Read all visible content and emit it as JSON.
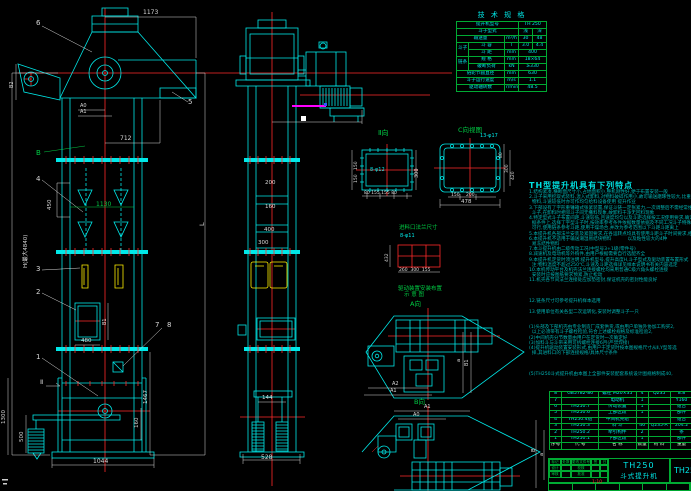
{
  "colors": {
    "line": "#00e8e8",
    "dim": "#d9d9d9",
    "green": "#00cc44",
    "red": "#ff2a2a",
    "yellow": "#ffee00",
    "magenta": "#ff00ff",
    "teal": "#00b4b4"
  },
  "spec_table": {
    "title": "技 术 规 格",
    "col_widths": [
      12,
      36,
      14,
      14,
      14
    ],
    "rows": [
      [
        {
          "t": "提升机型号",
          "cs": 3
        },
        {
          "t": "TH 250",
          "cs": 2
        }
      ],
      [
        {
          "t": "斗子型式",
          "cs": 3
        },
        {
          "t": "浅"
        },
        {
          "t": "深"
        }
      ],
      [
        {
          "t": "输送量",
          "cs": 2
        },
        {
          "t": "m³/h"
        },
        {
          "t": "30"
        },
        {
          "t": "48"
        }
      ],
      [
        {
          "t": "斗子",
          "rs": 2
        },
        {
          "t": "斗 容"
        },
        {
          "t": "l"
        },
        {
          "t": "3.0"
        },
        {
          "t": "4.4"
        }
      ],
      [
        {
          "t": "斗 距"
        },
        {
          "t": "mm"
        },
        {
          "t": "400",
          "cs": 2
        }
      ],
      [
        {
          "t": "链条",
          "rs": 2
        },
        {
          "t": "规 格"
        },
        {
          "t": "mm"
        },
        {
          "t": "18×64",
          "cs": 2
        }
      ],
      [
        {
          "t": "破断负荷"
        },
        {
          "t": "kN"
        },
        {
          "t": "≥330",
          "cs": 2
        }
      ],
      [
        {
          "t": "链轮节圆直径",
          "cs": 2
        },
        {
          "t": "mm"
        },
        {
          "t": "630",
          "cs": 2
        }
      ],
      [
        {
          "t": "斗子运行速度",
          "cs": 2
        },
        {
          "t": "m/s"
        },
        {
          "t": "1.1",
          "cs": 2
        }
      ],
      [
        {
          "t": "驱动轴转数",
          "cs": 2
        },
        {
          "t": "r/min"
        },
        {
          "t": "48.5",
          "cs": 2
        }
      ]
    ]
  },
  "notes": {
    "title": "TH型提升机具有下列特点",
    "lines": [
      "1.结构紧凑,横断面尺寸小,占地面积小,整机刚性好,便于布置安装一般",
      "2.斗子采用挖取式装料,混入式卸料,对物料破碎作用小,故可输送磨琢性较大,比重大一定块度的",
      "  物料,斗速较低时亦可作均匀给料设备使用 提升作业",
      "3.下部设有了字形重锤箱式张紧装置,保证斗链一定张紧力,一次调整后不需经常维护,了字形",
      "  斗子,在卸料时相邻斗子间无撒料现象,故卸料干净无回料现象",
      "4.特定型式斗子布置间距,斗速较低,且速度均匀以及斗距选择按工况使用要求,确定斗速布置依",
      "  据条件上,选择丁字型斗子时,按效率参考条件依据数量依据及不同工况斗子特殊斗速之上",
      "  可行,使用链条参考斗距,使用干燥场合,并改为参考范围以下斗距斗距离上",
      "5.本提升机各部法兰安装及紧固要求,在各运转点均具有使用斗距斗子时间要求,相差最大一只",
      "6.本提升机不适用于输送潮湿易结块物料           以及粘性较大的4种",
      "  易冻结性物料",
      "7.本斗提升机由二级传动工况(中型号3+1级(零件号)",
      "8.减速机及电动机等外购件,由用户根据需要自行选配齐全",
      "9.本提升机定货时须注明:提升机型号,提升高度H,斗子型式及驱动装置布置形式",
      "  注:物料温度不超过250℃,斗速及斗距选择详见样本说明书有关内容选定",
      "10.本机传动平台及机壳法兰连接螺栓均采用普通C级六角头螺栓连接",
      "  安装时应按图纸要求预紧,防止松动",
      "11.机壳各节间法兰连接处应加垫密封,保证机壳的密封性能良好",
      "",
      "",
      "",
      "12.链条尺寸可参考提升机样本选用",
      "",
      "13.使用单位有关各型二次运转化,安装时调整斗子一只",
      "",
      "",
      "(1)头部及下部机壳由专业制造厂成套供货,或由用户单独外协加工购买2,",
      "  以上必须带有斗子螺栓检验,符合上述螺栓规格及标准检验2,",
      "(2)中间机壳分节数量由用户在定货时一次确定好",
      "(3)加料斗与斗带采用可拆螺栓连接6月(严禁焊接)",
      "(4)提升机驱动装置安装形式,由用户于定货时按本图规格尺寸从Ⅱ,Y型等选",
      "  择,其进料口的下部连接规格/具体尺寸条件",
      "",
      "",
      "",
      "(5)TH250斗式提升机由本图上全部件安装配套系统设计图规格制成40,"
    ]
  },
  "bom": {
    "col_widths": [
      9,
      38,
      38,
      12,
      22,
      24,
      17
    ],
    "header": [
      "序号",
      "代  号",
      "名  称",
      "数量",
      "材 料",
      "重量",
      ""
    ],
    "rows": [
      [
        "8",
        "GB5782-86",
        "螺栓 M20×35",
        "4",
        "Q235",
        "8.8",
        ""
      ],
      [
        "7",
        "",
        "电动机",
        "1",
        "",
        "Y160",
        ""
      ],
      [
        "6",
        "TH250.7",
        "传动装置",
        "1",
        "",
        "组合",
        ""
      ],
      [
        "5",
        "TH250.6",
        "上部区段",
        "1",
        "",
        "部件",
        ""
      ],
      [
        "4",
        "TH250.4组",
        "中间机壳组",
        "",
        "",
        "组合",
        ""
      ],
      [
        "3",
        "TH250.3",
        "料 斗",
        "46",
        "Q235-A",
        "204.2",
        ""
      ],
      [
        "2",
        "TH250.2",
        "牵引构件",
        "2",
        "",
        "条",
        ""
      ],
      [
        "1",
        "TH250.1",
        "下部区段",
        "1",
        "",
        "部件",
        ""
      ]
    ]
  },
  "title_block": {
    "model": "TH250",
    "product": "斗式提升机",
    "drawing_no": "TH25",
    "rev_labels": [
      "标记",
      "处数",
      "更改文件号",
      "签名",
      "日期",
      "设计",
      "",
      "校核",
      "",
      "",
      "审核",
      "",
      "批准",
      "",
      ""
    ]
  },
  "annotations": [
    {
      "n": "dim-1173",
      "t": "1173",
      "x": 143,
      "y": 10,
      "c": "dim",
      "s": 6
    },
    {
      "n": "balloon-6",
      "t": "6",
      "x": 36,
      "y": 20,
      "c": "dim",
      "s": 7
    },
    {
      "n": "balloon-5",
      "t": "5",
      "x": 188,
      "y": 99,
      "c": "dim",
      "s": 7
    },
    {
      "n": "dim-b2",
      "t": "B2",
      "x": 10,
      "y": 88,
      "c": "dim",
      "s": 5,
      "r": 1
    },
    {
      "n": "dim-a0",
      "t": "A0",
      "x": 80,
      "y": 104,
      "c": "dim",
      "s": 5
    },
    {
      "n": "dim-a1",
      "t": "A1",
      "x": 80,
      "y": 110,
      "c": "dim",
      "s": 5
    },
    {
      "n": "label-b",
      "t": "B",
      "x": 36,
      "y": 150,
      "c": "green",
      "s": 7
    },
    {
      "n": "dim-712",
      "t": "712",
      "x": 120,
      "y": 136,
      "c": "dim",
      "s": 6
    },
    {
      "n": "balloon-4",
      "t": "4",
      "x": 36,
      "y": 176,
      "c": "dim",
      "s": 7
    },
    {
      "n": "dim-450",
      "t": "450",
      "x": 48,
      "y": 210,
      "c": "dim",
      "s": 5.5,
      "r": 1
    },
    {
      "n": "dim-1130",
      "t": "1130",
      "x": 96,
      "y": 202,
      "c": "green",
      "s": 6
    },
    {
      "n": "balloon-3",
      "t": "3",
      "x": 36,
      "y": 266,
      "c": "dim",
      "s": 7
    },
    {
      "n": "balloon-2",
      "t": "2",
      "x": 36,
      "y": 289,
      "c": "dim",
      "s": 7
    },
    {
      "n": "dim-480",
      "t": "480",
      "x": 81,
      "y": 339,
      "c": "dim",
      "s": 5.5
    },
    {
      "n": "dim-b1",
      "t": "B1",
      "x": 103,
      "y": 325,
      "c": "dim",
      "s": 5,
      "r": 1
    },
    {
      "n": "balloon-1",
      "t": "1",
      "x": 36,
      "y": 354,
      "c": "dim",
      "s": 7
    },
    {
      "n": "balloon-7",
      "t": "7",
      "x": 155,
      "y": 322,
      "c": "dim",
      "s": 7
    },
    {
      "n": "balloon-8",
      "t": "8",
      "x": 167,
      "y": 322,
      "c": "dim",
      "s": 7
    },
    {
      "n": "section-mark-ii",
      "t": "Ⅱ",
      "x": 40,
      "y": 379,
      "c": "dim",
      "s": 6.5
    },
    {
      "n": "dim-1467",
      "t": "1467",
      "x": 144,
      "y": 404,
      "c": "dim",
      "s": 5.5,
      "r": 1
    },
    {
      "n": "dim-160",
      "t": "160",
      "x": 135,
      "y": 428,
      "c": "dim",
      "s": 5.5,
      "r": 1
    },
    {
      "n": "dim-1300",
      "t": "1300",
      "x": 2,
      "y": 424,
      "c": "dim",
      "s": 5.5,
      "r": 1
    },
    {
      "n": "dim-500",
      "t": "500",
      "x": 20,
      "y": 442,
      "c": "dim",
      "s": 5.5,
      "r": 1
    },
    {
      "n": "dim-1044",
      "t": "1044",
      "x": 93,
      "y": 459,
      "c": "dim",
      "s": 6
    },
    {
      "n": "dim-h",
      "t": "H(最大4840)",
      "x": 24,
      "y": 268,
      "c": "dim",
      "s": 5.5,
      "r": 1
    },
    {
      "n": "dim-l",
      "t": "L",
      "x": 199,
      "y": 226,
      "c": "dim",
      "s": 6.5,
      "r": 1
    },
    {
      "n": "dim-200",
      "t": "200",
      "x": 265,
      "y": 181,
      "c": "dim",
      "s": 5.5
    },
    {
      "n": "dim-160-side",
      "t": "160",
      "x": 265,
      "y": 205,
      "c": "dim",
      "s": 5.5
    },
    {
      "n": "dim-400",
      "t": "400",
      "x": 264,
      "y": 228,
      "c": "dim",
      "s": 5.5
    },
    {
      "n": "dim-300-side",
      "t": "300",
      "x": 258,
      "y": 241,
      "c": "dim",
      "s": 5.5
    },
    {
      "n": "dim-144",
      "t": "144",
      "x": 262,
      "y": 396,
      "c": "dim",
      "s": 5.5
    },
    {
      "n": "dim-528",
      "t": "528",
      "x": 261,
      "y": 455,
      "c": "dim",
      "s": 6
    },
    {
      "n": "label-view-ii",
      "t": "Ⅱ向",
      "x": 378,
      "y": 130,
      "c": "green",
      "s": 7
    },
    {
      "n": "dim-8phi12",
      "t": "8-φ12",
      "x": 370,
      "y": 168,
      "c": "line",
      "s": 5
    },
    {
      "n": "dim-300-ii",
      "t": "300",
      "x": 415,
      "y": 178,
      "c": "dim",
      "s": 5,
      "r": 1
    },
    {
      "n": "dim-150-ii-a",
      "t": "150",
      "x": 355,
      "y": 170,
      "c": "dim",
      "s": 4.5,
      "r": 1
    },
    {
      "n": "dim-150-ii-b",
      "t": "150",
      "x": 355,
      "y": 183,
      "c": "dim",
      "s": 4.5,
      "r": 1
    },
    {
      "n": "dims-ii-bottom",
      "t": "80 155 155 80",
      "x": 364,
      "y": 192,
      "c": "dim",
      "s": 4.5
    },
    {
      "n": "label-view-c",
      "t": "C向视图",
      "x": 458,
      "y": 127,
      "c": "green",
      "s": 6.5
    },
    {
      "n": "dim-13phi17",
      "t": "13-φ17",
      "x": 480,
      "y": 134,
      "c": "line",
      "s": 5
    },
    {
      "n": "dim-80-c",
      "t": "80",
      "x": 500,
      "y": 158,
      "c": "dim",
      "s": 4.5,
      "r": 1
    },
    {
      "n": "dim-300-c",
      "t": "300",
      "x": 506,
      "y": 173,
      "c": "dim",
      "s": 4.5,
      "r": 1
    },
    {
      "n": "dim-420-c",
      "t": "420",
      "x": 512,
      "y": 180,
      "c": "dim",
      "s": 4.5,
      "r": 1
    },
    {
      "n": "dim-150-c",
      "t": "150",
      "x": 451,
      "y": 194,
      "c": "dim",
      "s": 4.5
    },
    {
      "n": "dim-200-c",
      "t": "200",
      "x": 466,
      "y": 194,
      "c": "dim",
      "s": 4.5
    },
    {
      "n": "dim-478",
      "t": "478",
      "x": 461,
      "y": 200,
      "c": "dim",
      "s": 5.5
    },
    {
      "n": "label-feed-flange",
      "t": "进料口法兰尺寸",
      "x": 399,
      "y": 226,
      "c": "green",
      "s": 5.5
    },
    {
      "n": "dim-8phi11",
      "t": "8-φ11",
      "x": 400,
      "y": 234,
      "c": "line",
      "s": 5
    },
    {
      "n": "dim-432",
      "t": "432",
      "x": 386,
      "y": 262,
      "c": "dim",
      "s": 4.5,
      "r": 1
    },
    {
      "n": "dims-feed-bottom",
      "t": "260  300  155",
      "x": 399,
      "y": 269,
      "c": "dim",
      "s": 4.5
    },
    {
      "n": "caption-drive-1",
      "t": "驱动装置安装布置",
      "x": 398,
      "y": 287,
      "c": "green",
      "s": 5.5
    },
    {
      "n": "caption-drive-2",
      "t": "示 意 图",
      "x": 404,
      "y": 293,
      "c": "green",
      "s": 5.5
    },
    {
      "n": "label-view-a",
      "t": "A向",
      "x": 410,
      "y": 301,
      "c": "green",
      "s": 6.5
    },
    {
      "n": "label-view-b",
      "t": "B向",
      "x": 414,
      "y": 399,
      "c": "green",
      "s": 6.5
    },
    {
      "n": "dim-a2-plan1",
      "t": "A2",
      "x": 392,
      "y": 382,
      "c": "dim",
      "s": 5
    },
    {
      "n": "dim-a1-plan1",
      "t": "A1",
      "x": 390,
      "y": 389,
      "c": "dim",
      "s": 5
    },
    {
      "n": "dim-a-plan1",
      "t": "a",
      "x": 457,
      "y": 362,
      "c": "dim",
      "s": 5,
      "r": 1
    },
    {
      "n": "dim-b1-plan1",
      "t": "B1",
      "x": 465,
      "y": 366,
      "c": "dim",
      "s": 5,
      "r": 1
    },
    {
      "n": "dim-a1-plan2",
      "t": "A1",
      "x": 424,
      "y": 405,
      "c": "dim",
      "s": 5
    },
    {
      "n": "dim-a0-plan2",
      "t": "A0",
      "x": 413,
      "y": 413,
      "c": "dim",
      "s": 5
    },
    {
      "n": "dim-b-plan2",
      "t": "B",
      "x": 532,
      "y": 452,
      "c": "dim",
      "s": 5.5,
      "r": 1
    },
    {
      "n": "dim-a-plan2",
      "t": "a",
      "x": 540,
      "y": 456,
      "c": "dim",
      "s": 5,
      "r": 1
    },
    {
      "n": "scale-note",
      "t": "1:10",
      "x": 592,
      "y": 481,
      "c": "red",
      "s": 4.5
    }
  ]
}
